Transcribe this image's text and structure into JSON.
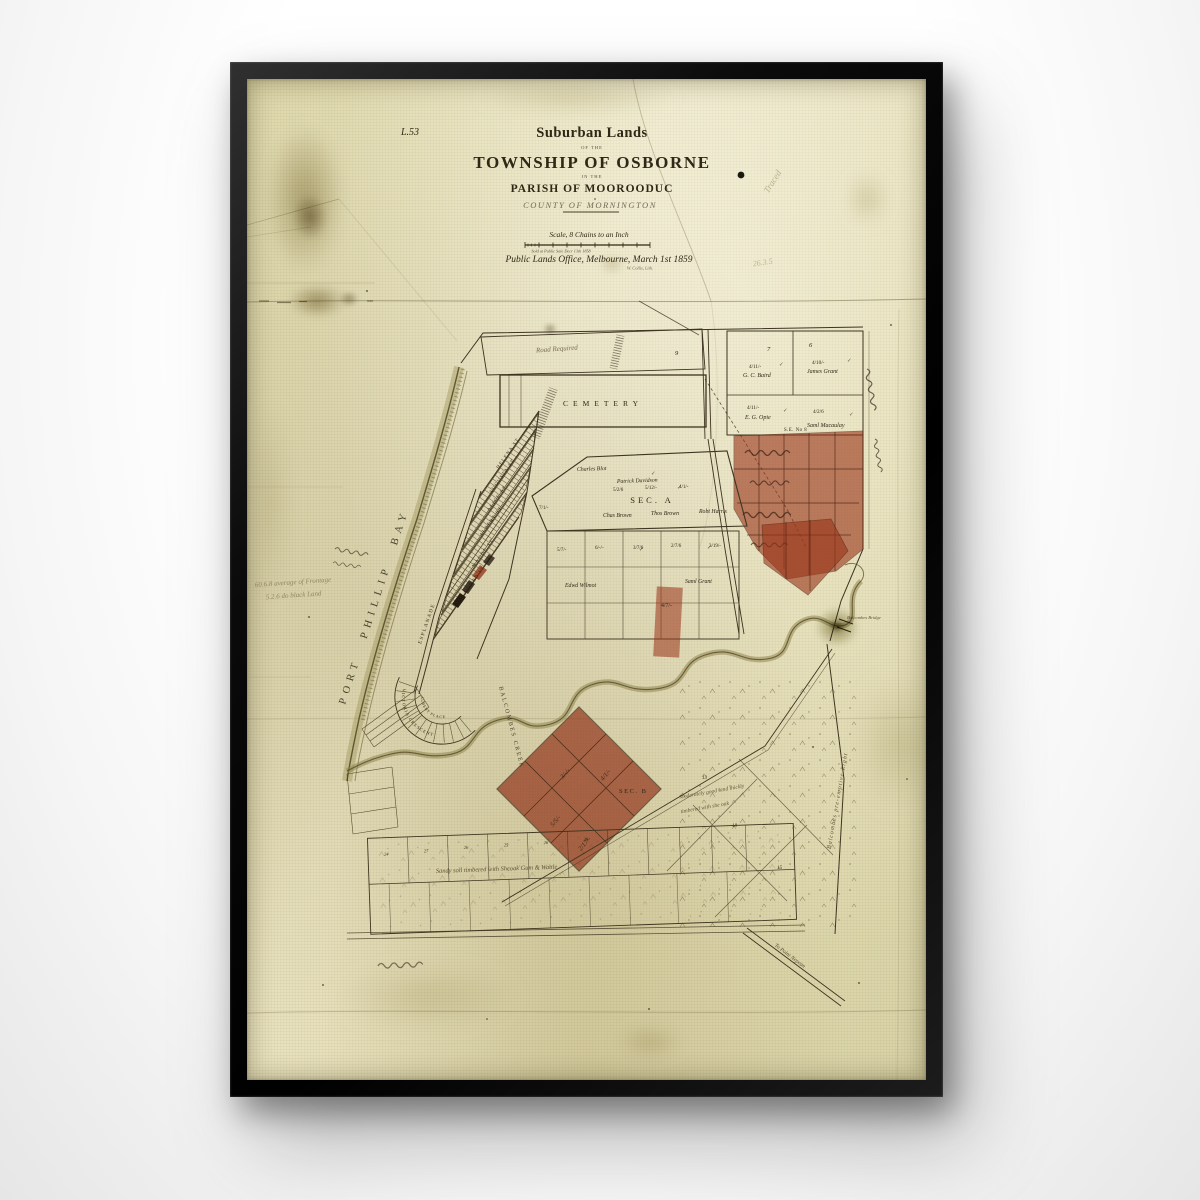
{
  "artwork": {
    "sheet_ref": "L.53",
    "title_script": "Suburban Lands",
    "title_of_the": "OF THE",
    "title_township": "TOWNSHIP OF OSBORNE",
    "title_in_the": "IN THE",
    "title_parish": "PARISH OF MOOROODUC",
    "title_county": "COUNTY OF MORNINGTON",
    "scale_line": "Scale, 8 Chains to an Inch",
    "sale_note": "Sold at Public Sale Decr 13th 1858",
    "office_line": "Public Lands Office, Melbourne, March 1st 1859",
    "lith_credit": "W. Collis, Lith."
  },
  "labels": {
    "bay": "PORT PHILLIP BAY",
    "cemetery": "CEMETERY",
    "sec_a": "SEC. A",
    "sec_b": "SEC. B",
    "se_no_8": "S.E. No 8",
    "creek": "BALCOMBES CREEK",
    "bridge": "Balcombes Bridge",
    "road_required": "Road Required",
    "preemptive_right": "Balcombes pre-emptive Right",
    "to_point_nepean": "To Point Nepean",
    "sandy_note": "Sandy soil timbered with Sheoak Gum & Wattle",
    "land_note_1": "Moderately good land thickly",
    "land_note_2": "timbered with she oak",
    "frontage_note_1": "60.6.8 average of Frontage",
    "frontage_note_2": "5.2.6 do black Land"
  },
  "streets": [
    "HELENA ST",
    "AUGUSTA ST",
    "ALICE ST",
    "ALBERT ST",
    "MAUDE ST",
    "ESPLANADE",
    "ALFRED ST",
    "ALBERT PLACE",
    "VICTORIA CRESCENT"
  ],
  "owners": [
    "G. C. Baird",
    "James Grant",
    "E. G. Opie",
    "Saml Macaulay",
    "Charles Blot",
    "Patrick Davidson",
    "Chas Brown",
    "Thos Brown",
    "Robt Harris",
    "Edwd Wilmot",
    "Saml Grant"
  ],
  "prices": [
    "4/11/-",
    "4/10/-",
    "4/11/-",
    "4/2/6",
    "5/7/-",
    "6/-/-",
    "3/7/6",
    "2/7/6",
    "3/19/-",
    "5/2/6",
    "5/12/-",
    "4/1/-",
    "4/7/-",
    "3/-/-",
    "5/5/-",
    "2/17/-",
    "7/1/-"
  ],
  "lot_numbers": [
    "9",
    "7",
    "6",
    "24",
    "27",
    "26",
    "25",
    "26",
    "30",
    "13",
    "18",
    "15"
  ],
  "pencil_notes": [
    "Traced",
    "26.3.5"
  ],
  "checks": "✓"
}
